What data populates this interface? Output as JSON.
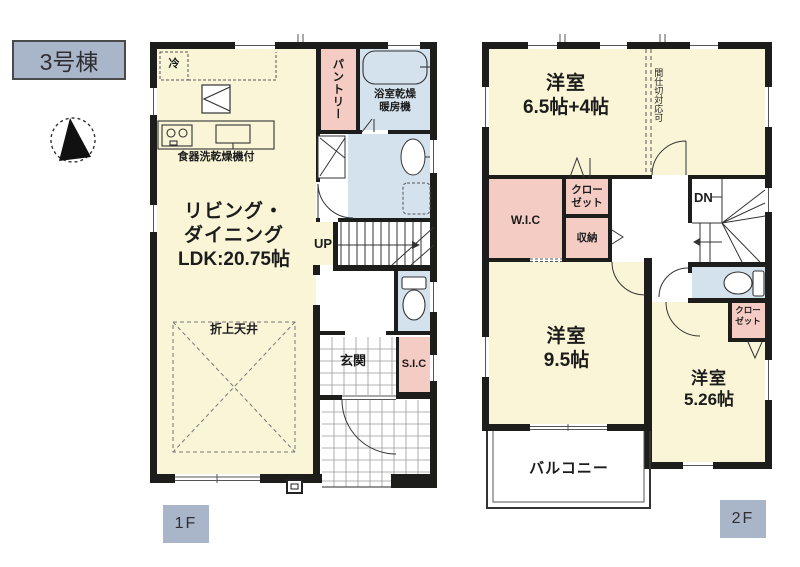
{
  "title_badge": "3号棟",
  "compass": {
    "icon": "north-arrow"
  },
  "colors": {
    "room": "#faf5d7",
    "closet_pink": "#f5ccc4",
    "wet_blue": "#d4e2ee",
    "wall": "#1d1d1b",
    "badge_bg": "#a9b5c8",
    "ink": "#1c1c1c"
  },
  "floor1": {
    "badge": "1F",
    "ldk": {
      "line1": "リビング・",
      "line2": "ダイニング",
      "line3": "LDK:20.75帖"
    },
    "ceiling_note": "折上天井",
    "fridge": "冷",
    "dishwasher_note": "食器洗乾燥機付",
    "pantry": "パントリー",
    "bath_line1": "浴室乾燥",
    "bath_line2": "暖房機",
    "stairs": "UP",
    "entrance": "玄関",
    "sic": "S.I.C"
  },
  "floor2": {
    "badge": "2F",
    "room1": {
      "name": "洋室",
      "size": "6.5帖+4帖"
    },
    "partition_note": "間仕切対応可",
    "wic": "W.I.C",
    "closet_a": {
      "line1": "クロー",
      "line2": "ゼット"
    },
    "storage": "収納",
    "stairs": "DN",
    "room2": {
      "name": "洋室",
      "size": "9.5帖"
    },
    "room3": {
      "name": "洋室",
      "size": "5.26帖"
    },
    "closet_b": {
      "line1": "クロー",
      "line2": "ゼット"
    },
    "balcony": "バルコニー"
  }
}
